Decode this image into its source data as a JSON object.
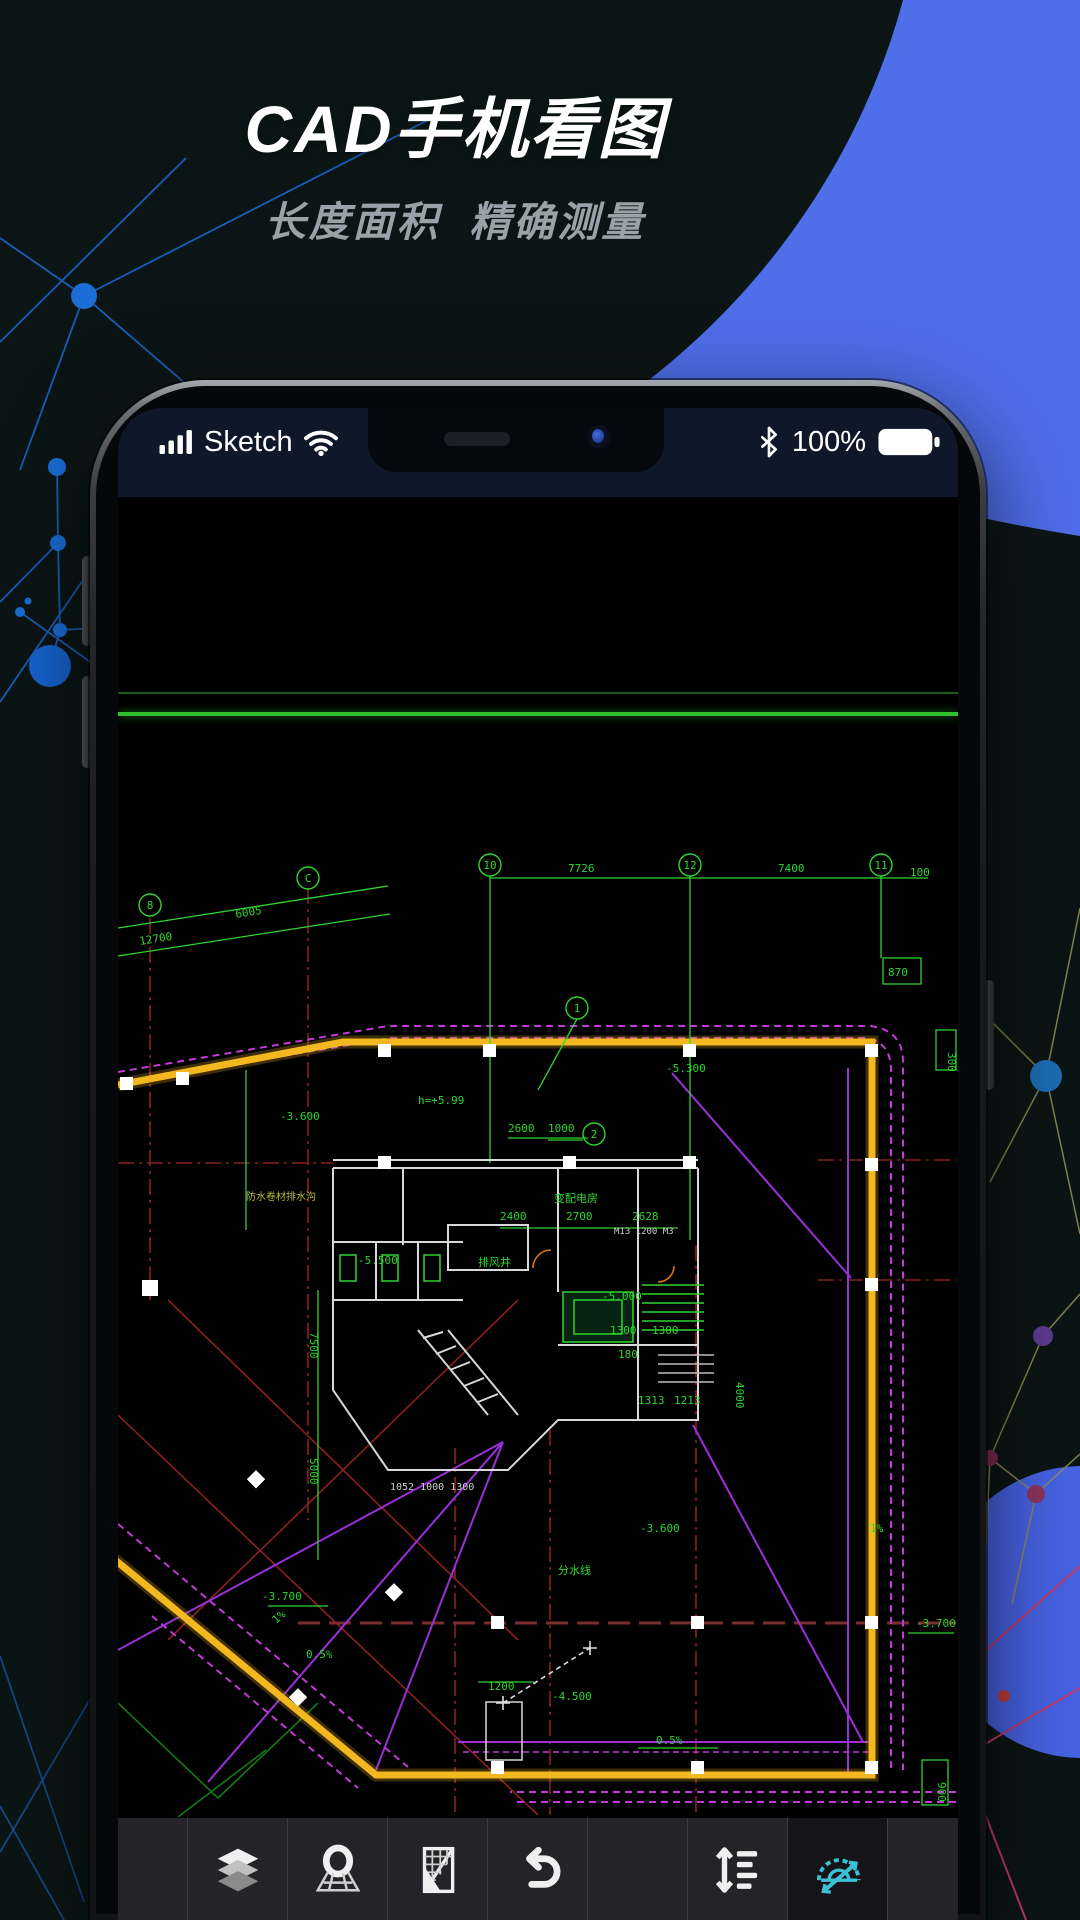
{
  "hero": {
    "title": "CAD手机看图",
    "subtitle": "长度面积  精确测量"
  },
  "statusbar": {
    "carrier": "Sketch",
    "battery_percent": "100%"
  },
  "toolbar": {
    "buttons": [
      {
        "icon": "layers"
      },
      {
        "icon": "locate-grid"
      },
      {
        "icon": "scale-ruler"
      },
      {
        "icon": "undo"
      },
      {
        "icon": "line-spacing"
      },
      {
        "icon": "protractor",
        "active": true
      }
    ]
  },
  "colors": {
    "accent_blue": "#4f6eea",
    "protractor_teal": "#3cc0d4",
    "cad_yellow": "#f3b81f",
    "cad_green": "#2fd42f",
    "cad_magenta": "#c23bd6",
    "cad_red": "#8b2020",
    "statusbar_bg": "#0f1828"
  },
  "cad": {
    "bubbles": [
      {
        "label": "8"
      },
      {
        "label": "C"
      },
      {
        "label": "10"
      },
      {
        "label": "12"
      },
      {
        "label": "11"
      },
      {
        "label": "1"
      },
      {
        "label": "2"
      }
    ],
    "labels": [
      {
        "text": "7726"
      },
      {
        "text": "7400"
      },
      {
        "text": "100"
      },
      {
        "text": "12700"
      },
      {
        "text": "6005"
      },
      {
        "text": "870"
      },
      {
        "text": "h=+5.99"
      },
      {
        "text": "-3.600"
      },
      {
        "text": "-5.300"
      },
      {
        "text": "防水卷材排水沟"
      },
      {
        "text": "排风井"
      },
      {
        "text": "变配电房"
      },
      {
        "text": "-5.500"
      },
      {
        "text": "2400"
      },
      {
        "text": "2700"
      },
      {
        "text": "2628"
      },
      {
        "text": "-5.000"
      },
      {
        "text": "1300"
      },
      {
        "text": "1300"
      },
      {
        "text": "180"
      },
      {
        "text": "1313"
      },
      {
        "text": "1213"
      },
      {
        "text": "4000"
      },
      {
        "text": "1052 1000 1300"
      },
      {
        "text": "2600"
      },
      {
        "text": "1000"
      },
      {
        "text": "分水线"
      },
      {
        "text": "-3.600"
      },
      {
        "text": "-3.700"
      },
      {
        "text": "0.5%"
      },
      {
        "text": "-3.700"
      },
      {
        "text": "1200"
      },
      {
        "text": "-4.500"
      },
      {
        "text": "0.5%"
      },
      {
        "text": "900"
      },
      {
        "text": "1%"
      },
      {
        "text": "1%"
      },
      {
        "text": "M13 1200 M3"
      },
      {
        "text": "7500"
      },
      {
        "text": "5000"
      },
      {
        "text": "300"
      }
    ]
  }
}
